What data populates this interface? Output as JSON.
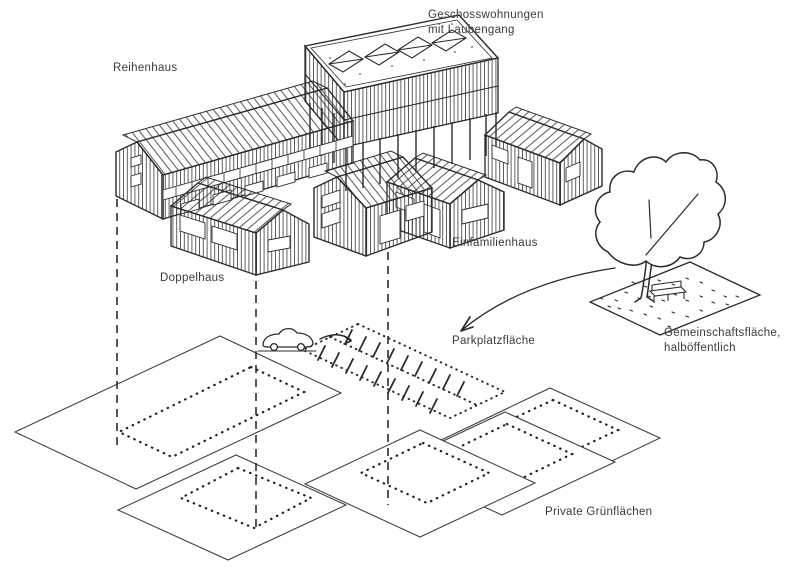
{
  "diagram": {
    "type": "hand-drawn architectural axonometric sketch",
    "ink_color": "#2b2b2b",
    "paper_color": "#ffffff",
    "labels": {
      "geschosswohnungen": {
        "line1": "Geschosswohnungen",
        "line2": "mit Laubengang"
      },
      "reihenhaus": "Reihenhaus",
      "doppelhaus": "Doppelhaus",
      "einfamilienhaus": "Einfamilienhaus",
      "parkplatzflaeche": "Parkplatzfläche",
      "gemeinschaftsflaeche": {
        "line1": "Gemeinschaftsfläche,",
        "line2": "halböffentlich"
      },
      "private_gruenflaechen": "Private Grünflächen"
    }
  }
}
